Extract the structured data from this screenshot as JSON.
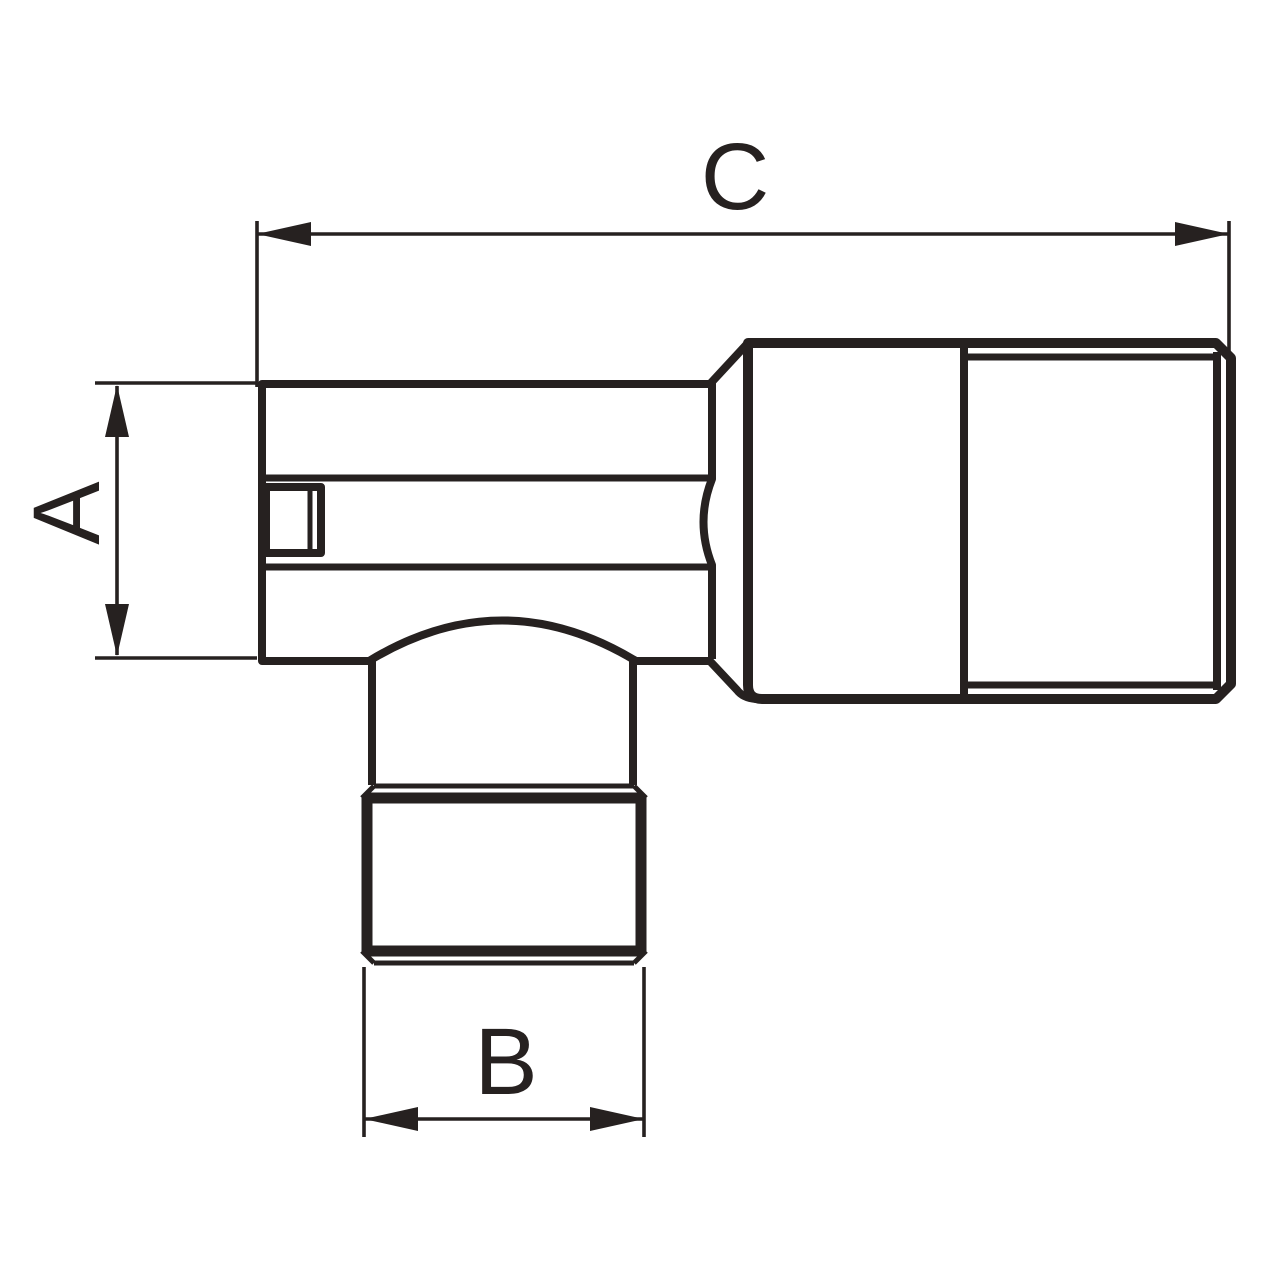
{
  "diagram": {
    "figure": "angle fitting technical line drawing, side view",
    "background_color": "#ffffff",
    "line_color": "#262120",
    "dimensions": [
      {
        "id": "C",
        "label": "C",
        "axis": "horizontal",
        "location": "top"
      },
      {
        "id": "A",
        "label": "A",
        "axis": "vertical",
        "location": "left"
      },
      {
        "id": "B",
        "label": "B",
        "axis": "horizontal",
        "location": "bottom"
      }
    ]
  }
}
